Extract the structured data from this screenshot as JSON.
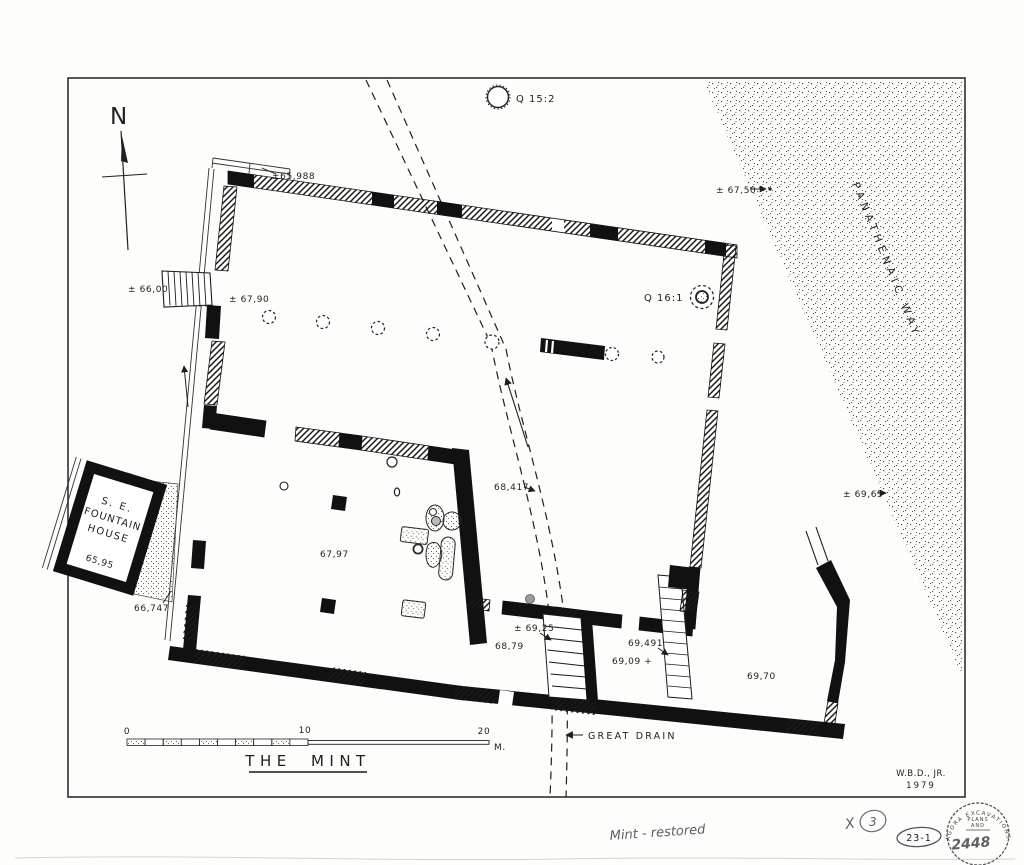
{
  "plan": {
    "title": "THE MINT",
    "north_label": "N",
    "road": "PANATHENAIC WAY",
    "drain": "GREAT DRAIN",
    "credit": {
      "line1": "W.B.D., JR.",
      "line2": "1979"
    },
    "wells": {
      "q15": "Q 15:2",
      "q16": "Q 16:1"
    },
    "fountain_house": {
      "l1": "S. E.",
      "l2": "FOUNTAIN",
      "l3": "HOUSE",
      "elev": "65,95"
    },
    "elevations": {
      "nw_corner": "±65,988",
      "road_upper": "± 67,50",
      "west_stairs": "± 66,00",
      "north_room": "± 67,90",
      "drain_mid": "68,417",
      "sw_room": "67,97",
      "fountain_corner": "66,747",
      "road_lower": "± 69,65",
      "stair_room": "± 69,25",
      "south_room_w": "68,79",
      "stair_east": "69,491",
      "south_room_m": "69,09 +",
      "south_room_e": "69,70"
    },
    "scale": {
      "t0": "0",
      "t10": "10",
      "t20": "20",
      "unit": "M."
    }
  },
  "annotations": {
    "note": "Mint - restored",
    "x_mark": "X",
    "circled_num": "3",
    "file_num": "23-1",
    "stamp_ring": "AGORA  EXCAVATIONS",
    "stamp_l1": "PLANS",
    "stamp_l2": "AND",
    "stamp_number": "2448"
  },
  "colors": {
    "ink": "#1a1a1a",
    "paper": "#fdfdfb",
    "pencil": "#5f5f66"
  }
}
